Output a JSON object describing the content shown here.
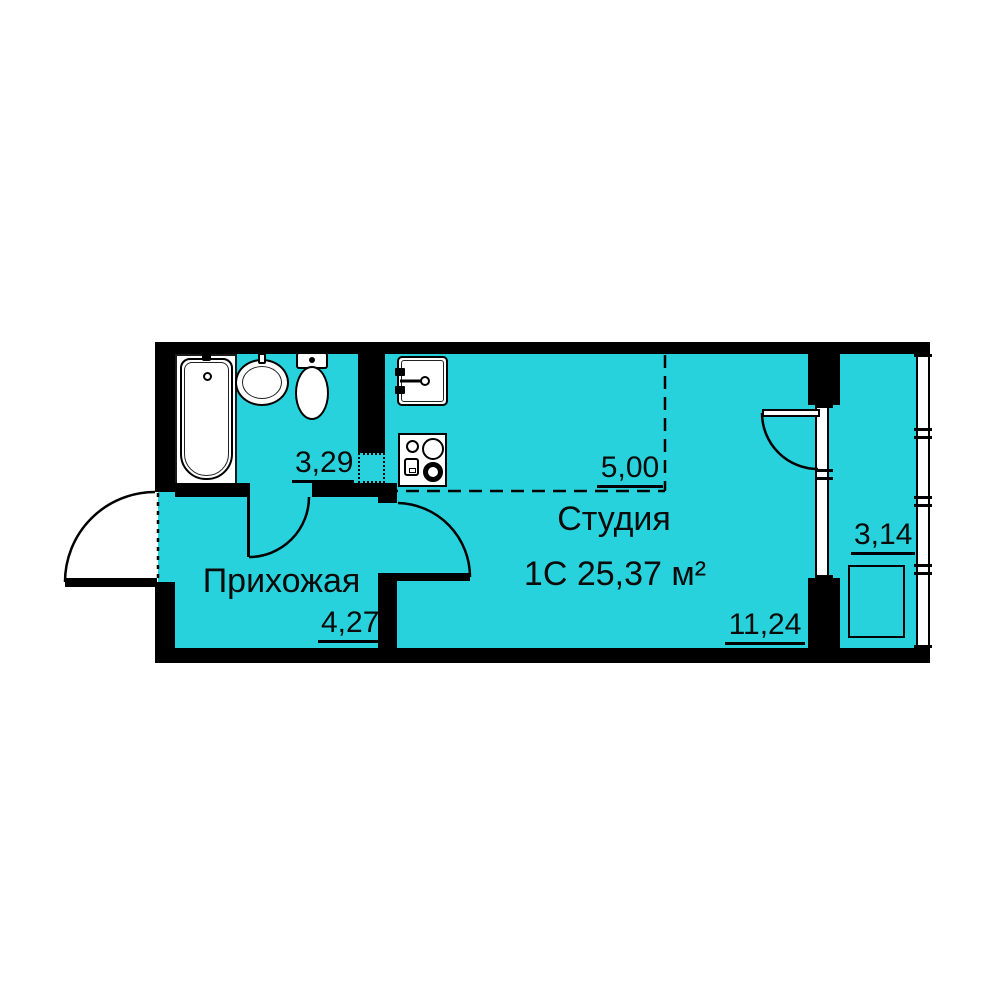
{
  "floorplan": {
    "unit": {
      "name": "Студия",
      "details": "1С 25,37 м²"
    },
    "rooms": {
      "hallway": {
        "label": "Прихожая",
        "area": "4,27"
      },
      "bathroom": {
        "area": "3,29"
      },
      "kitchen_zone": {
        "area": "5,00"
      },
      "living_zone": {
        "area": "11,24"
      },
      "balcony": {
        "area": "3,14"
      }
    },
    "colors": {
      "floor": "#28D2DC",
      "walls": "#000000",
      "fixtures": "#FFFFFF"
    }
  }
}
